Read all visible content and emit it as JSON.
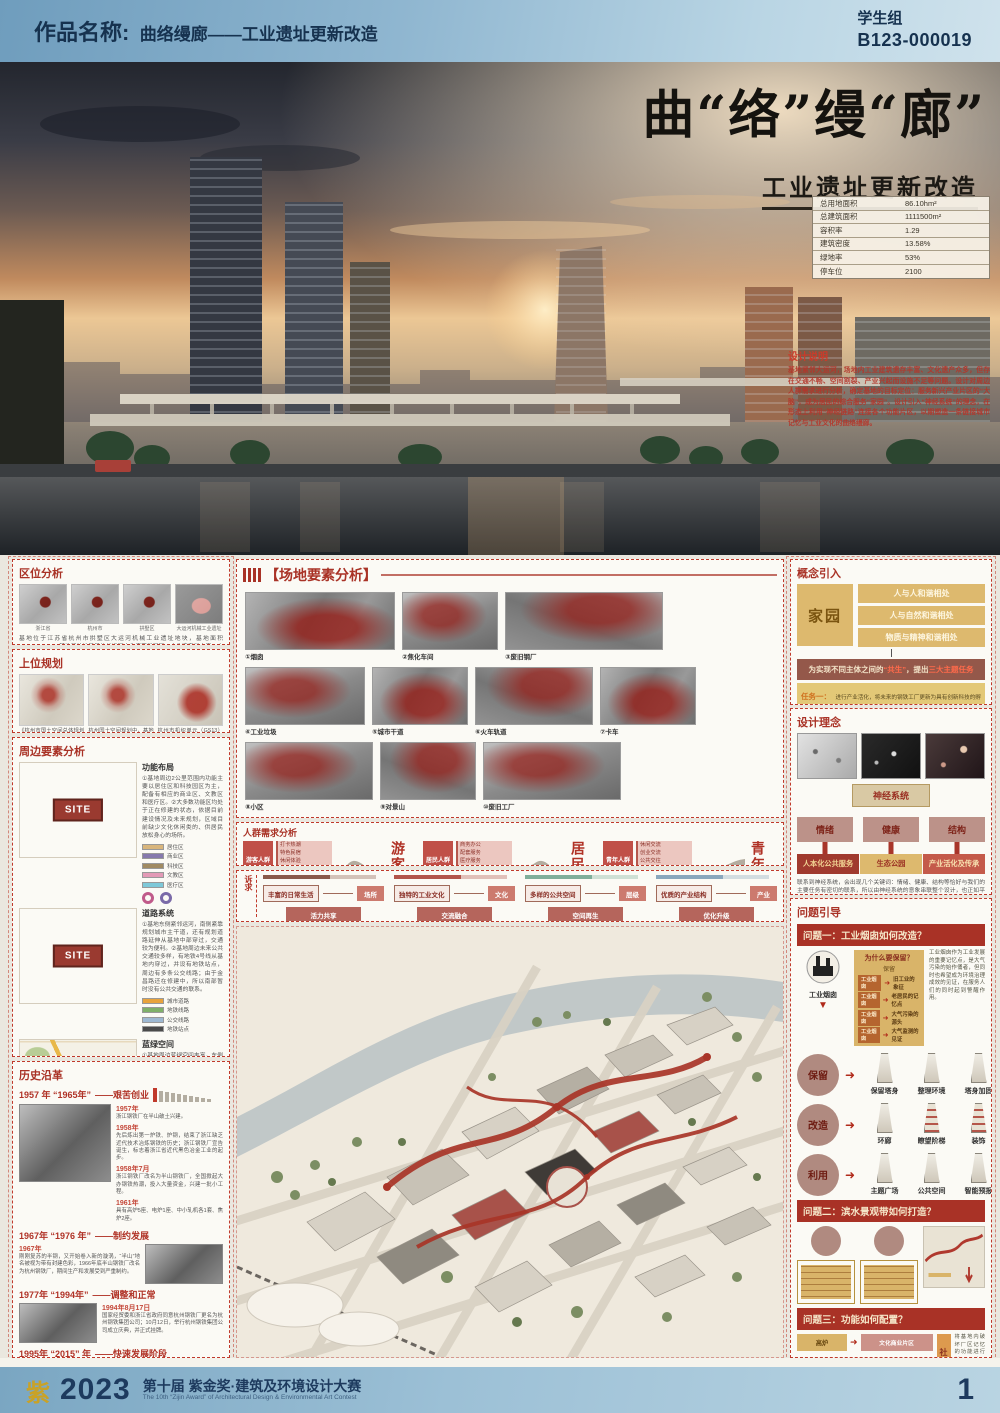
{
  "colors": {
    "accent_red": "#a93226",
    "gold": "#d9b469",
    "header_blue": "#7aa6c2",
    "navy": "#16324f",
    "banner_red": "#a93226",
    "pink": "#cc9289"
  },
  "header": {
    "label": "作品名称:",
    "title": "曲络缦廊——工业遗址更新改造",
    "group": "学生组",
    "code": "B123-000019"
  },
  "hero": {
    "title": "曲“络”缦“廊”",
    "subtitle": "工业遗址更新改造",
    "stats": [
      {
        "k": "总用地面积",
        "v": "86.10hm²"
      },
      {
        "k": "总建筑面积",
        "v": "1111500m²"
      },
      {
        "k": "容积率",
        "v": "1.29"
      },
      {
        "k": "建筑密度",
        "v": "13.58%"
      },
      {
        "k": "绿地率",
        "v": "53%"
      },
      {
        "k": "停车位",
        "v": "2100"
      }
    ],
    "notes_title": "设计说明",
    "notes": "基地紧邻大运河，场地内工业建筑遗存丰富、文化遗产众多，但存在交通不畅、空间割裂、产业兴起而设施不足等问题。设计对周边人群需求进行分析，确定基地的目标定位：服务新兴产业片区的“大脑”，成为居民的综合服务“家园”。设计引入“神经系统”的理念，在形态上利用“神经链路”连接各个功能片区，以期塑造一条链接城市记忆与工业文化的曲络缦廊。"
  },
  "left": {
    "quwei": {
      "title": "区位分析",
      "maps": [
        "浙江省",
        "杭州市",
        "拱墅区",
        "大运河机械工业遗址"
      ],
      "text": "基地位于江苏省杭州市拱墅区大运河机械工业遗址地块，基地面积861013.14m²。基地所处地段是杭州运河文化底蕴最深厚、文化遗产最丰富、文旅价值最优越的核心段，具备显著的区域特点和未来发展机遇。"
    },
    "shangwei": {
      "title": "上位规划",
      "captions": [
        "《杭州市国土空间总体规划发展战略》提出构建“一主四片三副城”的开放发展格局，其中基地位于城西片区。",
        "杭州国土空间规划中，基地紧邻半山战略节点，定位未来科技文化特区，主要布局未来产业和相关配套设施，建设成为未来的科技新城。",
        "杭州市机织单元（GS13）控制性详细规划明确，基地所在区域内规划用地性质以工业用地、商业文化设施用地、公园绿地、居住混合用地为主。"
      ]
    },
    "zhoubian": {
      "title": "周边要素分析",
      "site": "SITE",
      "rows": [
        {
          "h": "功能布局",
          "t": "①基地周边2公里范围内功能主要以居住区和科技园区为主，配备有相应的商业区、文教区和医疗区。②大多数功能区均处于正在修建的状态，依据目前建设情况及未来规划，区域目前缺少文化休闲类的、供居民放松身心的场所。",
          "legend": [
            {
              "c": "#d8b57c",
              "t": "居住区"
            },
            {
              "c": "#8679ad",
              "t": "商业区"
            },
            {
              "c": "#a08a62",
              "t": "科技区"
            },
            {
              "c": "#e39ab6",
              "t": "文教区"
            },
            {
              "c": "#7ec8d8",
              "t": "医疗区"
            }
          ]
        },
        {
          "h": "道路系统",
          "t": "①基地东侧紧邻运河，南侧紧靠规划城市主干道，还有规划道路延伸从基地中部穿过，交通较为便利。②基地周边未来公共交通较多样，有地铁4号线从基地内穿过，并设有地铁站点，周边有多条公交线路；由于金昌路还在修建中，所以南部暂时没有公共交通的联系。",
          "legend": [
            {
              "c": "#e8a33d",
              "t": "城市道路"
            },
            {
              "c": "#7fb069",
              "t": "地铁线路"
            },
            {
              "c": "#9db8d2",
              "t": "公交线路"
            },
            {
              "c": "#4a4a4a",
              "t": "地铁站点"
            }
          ]
        },
        {
          "h": "蓝绿空间",
          "t": "①基地周边蓝绿空间丰富，东侧紧邻杭州半山国家森林公园，西侧有康桥花海和城北生态公园；杭州作为名副其实的江南水乡，水系网络较为丰富，京杭运河的水系分支自西向东伸入基地内部，丰富了基地的景观体系。",
          "legend": [
            {
              "c": "#9db8d2",
              "t": "水系"
            },
            {
              "c": "#b5c99a",
              "t": "生态区"
            }
          ]
        }
      ]
    },
    "lishi": {
      "title": "历史沿革",
      "phases": [
        {
          "years": "1957 年 “1965年”",
          "name": "——艰苦创业",
          "events": [
            {
              "d": "1957年",
              "t": "浙江钢铁厂在半山破土兴建。"
            },
            {
              "d": "1958年",
              "t": "先后炼出第一炉铁、炉钢，结束了浙江缺乏近代技术冶炼钢铁的历史；浙江钢铁厂宣告诞生，标志着浙江省近代黑色冶金工业的起步。"
            },
            {
              "d": "1958年7月",
              "t": "浙江钢铁厂改名为半山钢铁厂，全国掀起大办钢铁热潮，投入大量资金，兴建一批小工程。"
            },
            {
              "d": "1961年",
              "t": "具有高炉5座、电炉1座、中小轧机各1套、焦炉2座。"
            }
          ]
        },
        {
          "years": "1967年 “1976 年”",
          "name": "——制约发展",
          "events": [
            {
              "d": "1967年",
              "t": "刚刚复苏的半钢，又开始卷入新的漩涡，“半山”地名被视为带有封建色彩，1966年底半山钢铁厂改名为杭州钢铁厂，期间生产和发展受到严重制约。"
            }
          ]
        },
        {
          "years": "1977年 “1994年”",
          "name": "——调整和正常",
          "events": [
            {
              "d": "1994年8月17日",
              "t": "国家经贸委和浙江省政府同意杭州钢铁厂更名为杭州钢铁集团公司；10月12日，举行杭州钢铁集团公司成立庆典，并正式挂牌。"
            }
          ]
        },
        {
          "years": "1995年 “2015” 年",
          "name": "——快速发展阶段",
          "events": [
            {
              "d": "1998年3月11日",
              "t": "杭钢股份在上海证券交易所上市。"
            },
            {
              "d": "2004年3月",
              "t": "进入全国最大企业百强。"
            },
            {
              "d": "2015年12月23日",
              "t": "杭钢半山基地全面关停，启动基地转型升级工作。"
            }
          ]
        }
      ]
    }
  },
  "middle": {
    "changdi": {
      "title": "【场地要素分析】",
      "items": [
        "①烟囱",
        "②焦化车间",
        "③废旧钢厂",
        "④工业垃圾",
        "⑤城市干道",
        "⑥火车轨道",
        "⑦卡车",
        "⑧小区",
        "⑨对景山",
        "⑩废旧工厂",
        "⑪老旧民房",
        "⑫废旧公园",
        "⑬蝶形花园"
      ]
    },
    "renqun": {
      "title": "人群需求分析",
      "groups": [
        {
          "tag": "游客人群",
          "big": "游客",
          "needs": [
            "打卡热潮",
            "特色民宿",
            "休闲体验",
            "工业文化",
            "生态体验"
          ]
        },
        {
          "tag": "居民人群",
          "big": "居民",
          "needs": [
            "商务办公",
            "配套服务",
            "医疗服务",
            "智慧生活",
            "文化生活"
          ]
        },
        {
          "tag": "青年人群",
          "big": "青年",
          "needs": [
            "休闲交流",
            "创业交流",
            "公共交往",
            "商务办公",
            "休闲娱乐"
          ]
        }
      ]
    },
    "suqiu": {
      "side": "诉求",
      "items": [
        {
          "need": "丰富的日常生活",
          "tag": "场所",
          "action": "活力共享",
          "color": "#8a5a4a"
        },
        {
          "need": "独特的工业文化",
          "tag": "文化",
          "action": "交流融合",
          "color": "#b2544a"
        },
        {
          "need": "多样的公共空间",
          "tag": "层级",
          "action": "空间再生",
          "color": "#7fae9a"
        },
        {
          "need": "优质的产业结构",
          "tag": "产业",
          "action": "优化升级",
          "color": "#8aa7bd"
        }
      ]
    }
  },
  "right": {
    "gainian": {
      "title": "概念引入",
      "home": "家园",
      "bars": [
        "人与人和谐相处",
        "人与自然和谐相处",
        "物质与精神和谐相处"
      ],
      "statement_pre": "为实现不同主体之间的",
      "statement_hl": "“共生”",
      "statement_mid": "，提出",
      "statement_hl2": "三大主题任务",
      "tasks": [
        {
          "h": "任务一：",
          "t": "进行产业活化，将未来的钢铁工厂更新为具有创新科技的孵化基地和创新人才的培育基地。"
        },
        {
          "h": "任务二：",
          "t": "进行人本化公共服务空间设计，使其具有产业活化的特质，兼具时尚感和对周边居民的亲和吸引力。"
        },
        {
          "h": "任务三：",
          "t": "进行生态公园的设计，响应绿色城市的国家号召，成为城市西片区的绿肺。"
        }
      ]
    },
    "sheji": {
      "title": "设计理念",
      "keyword": "神经系统",
      "triad": [
        "情绪",
        "健康",
        "结构"
      ],
      "mapped": [
        "人本化公共服务",
        "生态公园",
        "产业活化及传承"
      ],
      "text": "联系到神经系统，会出现几个关键词：情绪、健康、结构等恰好与我们的主要任务有密切的联系，所以由神经系统的意象串联整个设计，也正如平面所示，各产业动力链连接我们的各功能片区。"
    },
    "wenti": {
      "title": "问题引导",
      "q1": {
        "banner": "问题一：工业烟囱如何改造？",
        "icon_label": "工业烟囱",
        "why_title": "为什么要保留？",
        "why_sub": "保留",
        "why_rows": [
          {
            "a": "工业烟囱",
            "b": "旧工业的象征"
          },
          {
            "a": "工业烟囱",
            "b": "老居民的记忆点"
          },
          {
            "a": "工业烟囱",
            "b": "大气污染的源头"
          },
          {
            "a": "工业烟囱",
            "b": "大气监测的见证"
          }
        ],
        "side": "工业烟囱作为工业发展的重要记忆点，是大气污染的始作俑者，但同时也希望成为环境治理成效的见证，在服务人们的同时起到警醒作用。",
        "strategies": [
          {
            "c": "保留",
            "s1": "保留塔身",
            "s2": "整理环境",
            "s3": "塔身加固"
          },
          {
            "c": "改造",
            "s1": "环廊",
            "s2": "瞭望阶梯",
            "s3": "装饰"
          },
          {
            "c": "利用",
            "s1": "主题广场",
            "s2": "公共空间",
            "s3": "智能预报"
          }
        ]
      },
      "q2": {
        "banner": "问题二：滨水景观带如何打造？"
      },
      "q3": {
        "banner": "问题三：功能如何配置？",
        "maps": [
          {
            "a": "高炉",
            "b": "文化商业片区"
          },
          {
            "a": "焦化车间",
            "b": "艺术家工作坊"
          },
          {
            "a": "传统厂房",
            "b": "居民智能活动中心"
          },
          {
            "a": "火车轨道",
            "b": "滨水生态公园"
          }
        ],
        "vertical": "社区十五分钟步行生活圈",
        "side": "将基地内破坏厂区记忆的功能进行纠正，对于闲置的厂房进行功能植入，在保留厂区记忆的同时，满足现在社区人们的日常生活需求，就社区十五分钟步行生活圈中缺少的功能进行补给，实现价值最大化。"
      }
    }
  },
  "footer": {
    "logo": "紫",
    "year": "2023",
    "title": "第十届 紫金奖·建筑及环境设计大赛",
    "subtitle": "The 10th “Zijin Award” of Architectural Design & Environmental Art Contest",
    "page": "1"
  }
}
